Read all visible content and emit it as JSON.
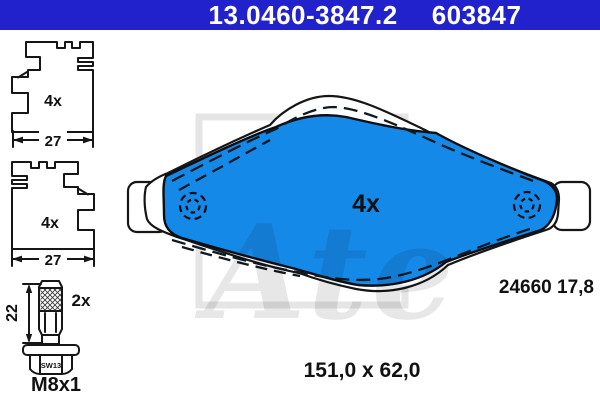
{
  "header": {
    "part_number": "13.0460-3847.2",
    "ref_number": "603847"
  },
  "clip_top": {
    "qty": "4x",
    "width": "27"
  },
  "clip_bottom": {
    "qty": "4x",
    "width": "27"
  },
  "bolt": {
    "qty": "2x",
    "length": "22",
    "wrench": "SW13",
    "thread": "M8x1"
  },
  "pad": {
    "qty": "4x",
    "wva": "24660 17,8",
    "size": "151,0 x 62,0"
  },
  "watermark": {
    "brand": "Ate"
  },
  "colors": {
    "header_bg": "#2222cc",
    "pad_blue": "#1589e8",
    "line_black": "#161616",
    "watermark_gray": "#e8e8e8"
  }
}
